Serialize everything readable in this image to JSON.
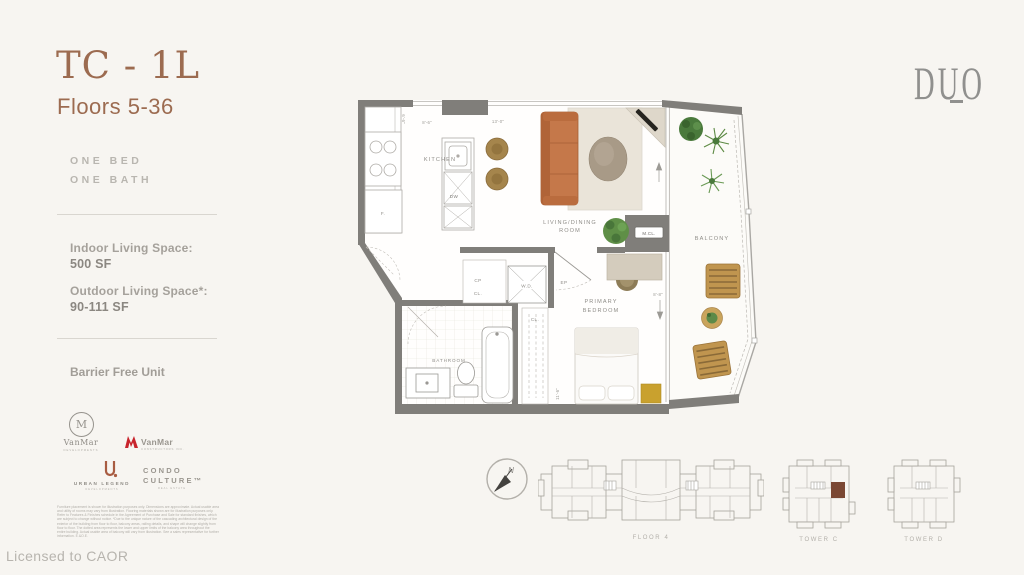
{
  "sidebar": {
    "unit_code": "TC - 1L",
    "floors": "Floors 5-36",
    "bed_bath": [
      "ONE BED",
      "ONE BATH"
    ],
    "indoor_label": "Indoor Living Space:",
    "indoor_value": "500 SF",
    "outdoor_label": "Outdoor Living Space*:",
    "outdoor_value": "90-111 SF",
    "barrier_free": "Barrier Free Unit",
    "disclaimer": "Furniture placement is shown for illustration purposes only. Dimensions are approximate. Actual usable area and utility of rooms may vary from illustration. Flooring materials shown are for illustration purposes only. Refer to Features & Finishes schedule in the Agreement of Purchase and Sale for standard finishes, which are subject to change without notice. *Due to the unique nature of the cascading architectural design of the exterior of the building from floor to floor, balcony areas, railing details, and shape will change slightly from floor to floor. The dotted area represents the lower and upper limits of the balcony area throughout the entire building. Actual usable area of balcony will vary from illustration. See a sales representative for further information. E.&O.E.",
    "licensed": "Licensed to CAOR"
  },
  "brand": {
    "name": "DUO"
  },
  "logos": {
    "vanmar_dev": {
      "monogram": "M",
      "name": "VanMar",
      "tagline": "DEVELOPMENTS"
    },
    "vanmar_con": {
      "name": "VanMar",
      "tagline": "CONSTRUCTORS INC."
    },
    "urban_legend": {
      "name": "URBAN LEGEND",
      "tagline": "DEVELOPMENTS"
    },
    "condo_culture": {
      "line1": "CONDO",
      "line2": "CULTURE™",
      "tagline": "REAL ESTATE"
    }
  },
  "plan": {
    "kitchen": "KITCHEN",
    "living_line1": "LIVING/DINING",
    "living_line2": "ROOM",
    "balcony": "BALCONY",
    "primary_line1": "PRIMARY",
    "primary_line2": "BEDROOM",
    "bathroom": "BATHROOM",
    "mcl": "M.CL.",
    "wd": "W.D.",
    "cp": "CP",
    "cl_foyer": "CL.",
    "cl_bedroom": "CL.",
    "ep": "EP",
    "fridge": "F.",
    "dishwasher": "DW",
    "dims": {
      "kitchen_w": "8'-6\"",
      "living_w": "13'-0\"",
      "kitchen_d": "6'-6\"",
      "bedroom_w": "8'-8\"",
      "bedroom_d": "11'-6\""
    }
  },
  "keyplans": {
    "floor": "FLOOR 4",
    "tower_c": "TOWER C",
    "tower_d": "TOWER D",
    "north": "N"
  },
  "colors": {
    "accent_brown": "#9c6b50",
    "highlight_unit": "#7a4733",
    "wall_gray": "#807e7a",
    "background": "#f7f5f1"
  }
}
